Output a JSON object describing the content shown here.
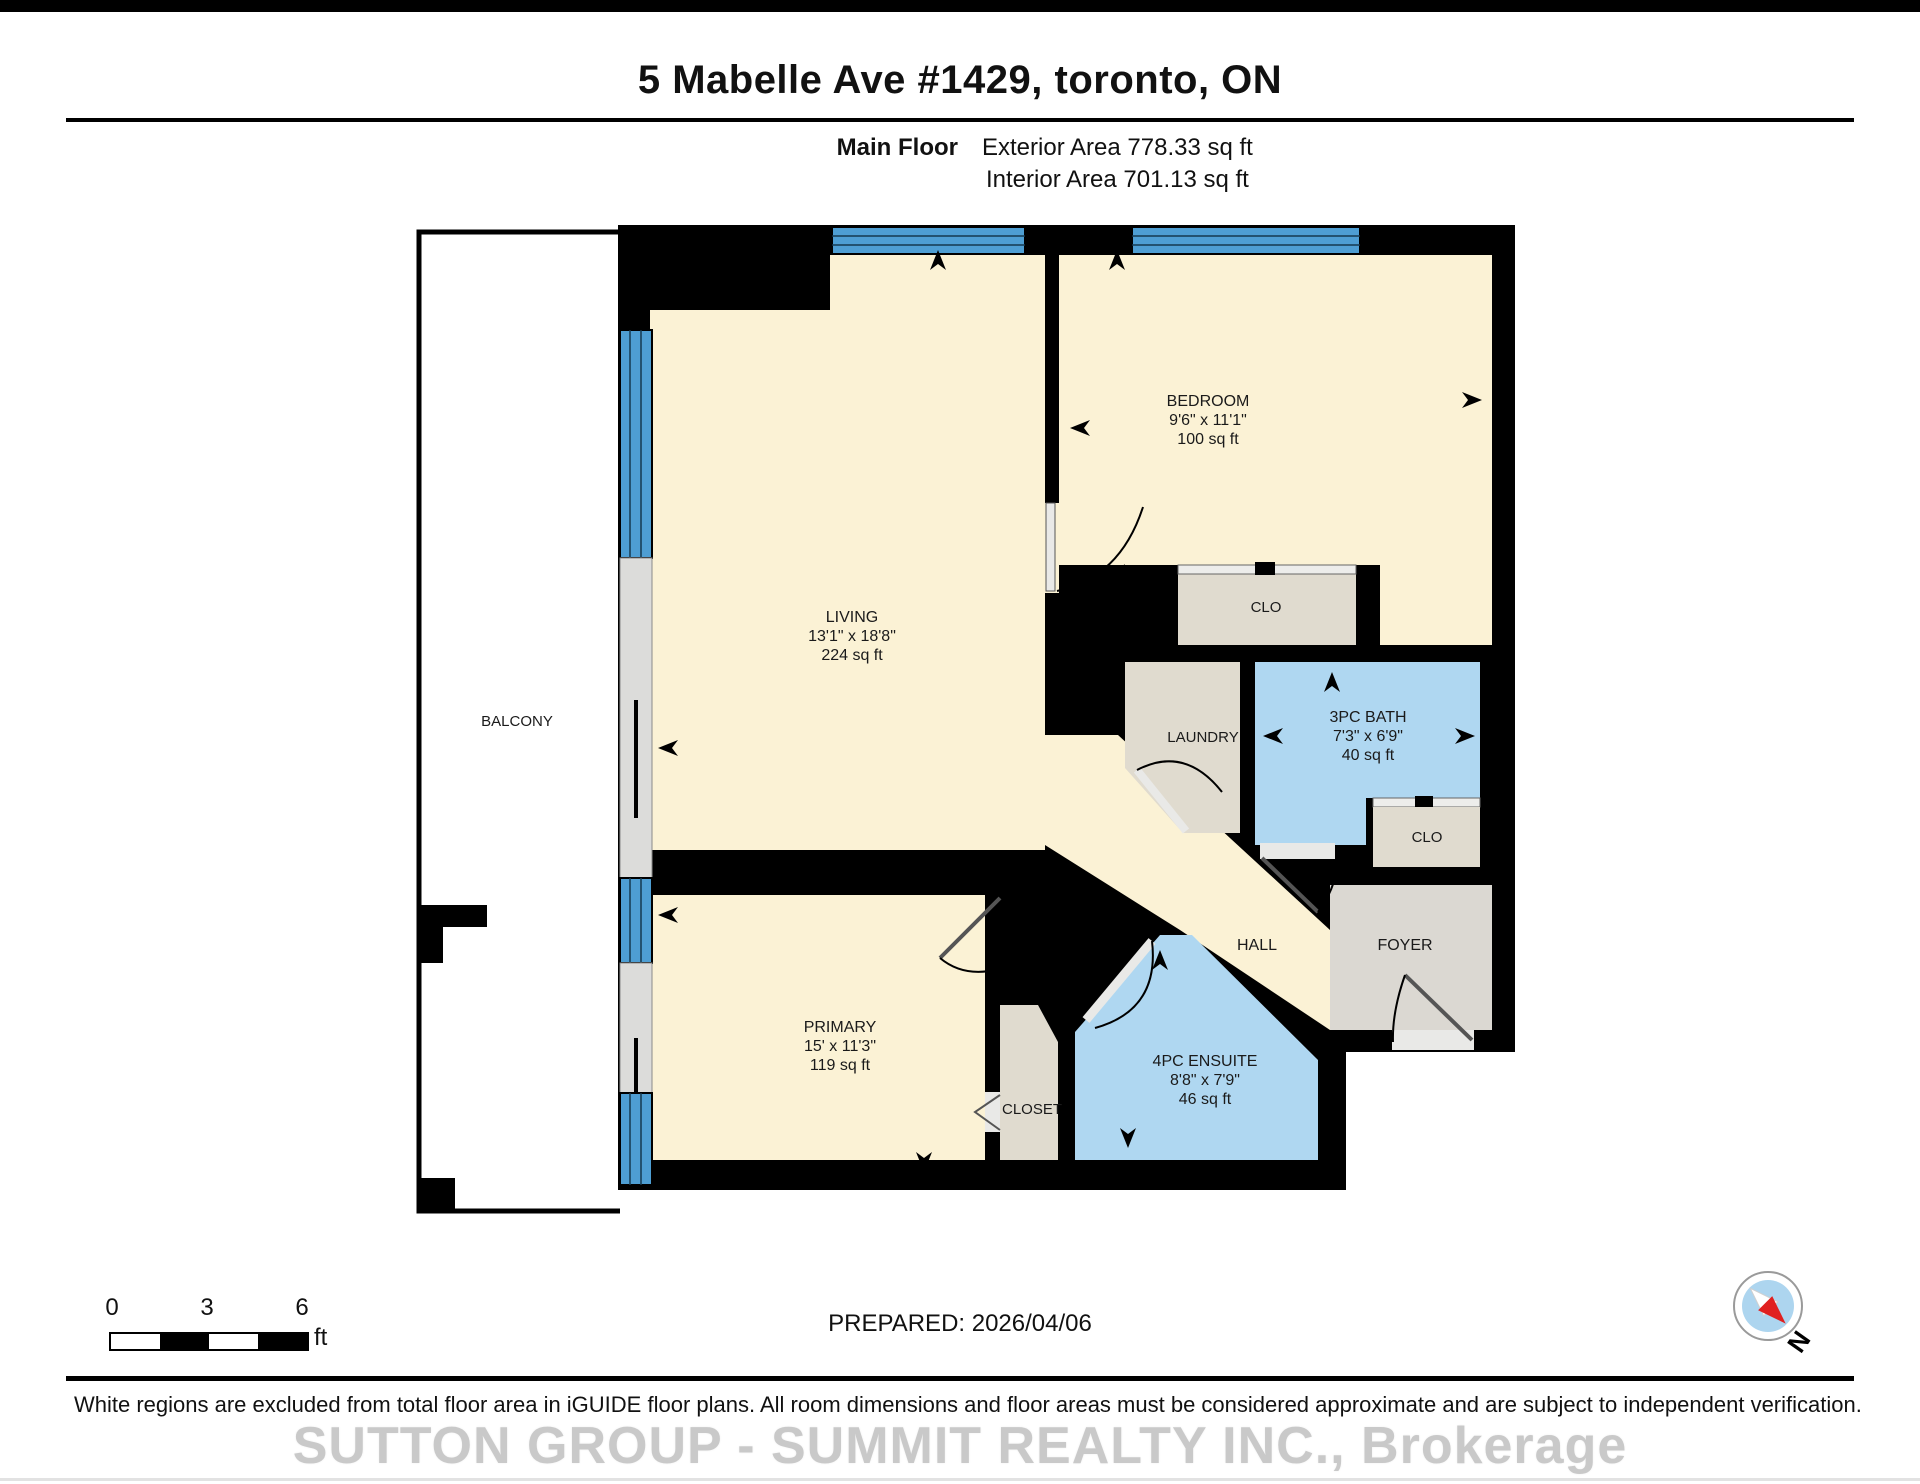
{
  "header": {
    "title": "5 Mabelle Ave #1429, toronto, ON",
    "floor_label": "Main Floor",
    "exterior_area": "Exterior Area 778.33 sq ft",
    "interior_area": "Interior Area 701.13 sq ft"
  },
  "rooms": {
    "living": {
      "name": "LIVING",
      "dims": "13'1\" x 18'8\"",
      "area": "224 sq ft"
    },
    "bedroom": {
      "name": "BEDROOM",
      "dims": "9'6\" x 11'1\"",
      "area": "100 sq ft"
    },
    "bedroom_closet": {
      "name": "CLO"
    },
    "bath": {
      "name": "3PC BATH",
      "dims": "7'3\" x 6'9\"",
      "area": "40 sq ft"
    },
    "laundry": {
      "name": "LAUNDRY"
    },
    "foyer_closet": {
      "name": "CLO"
    },
    "hall": {
      "name": "HALL"
    },
    "foyer": {
      "name": "FOYER"
    },
    "primary": {
      "name": "PRIMARY",
      "dims": "15' x 11'3\"",
      "area": "119 sq ft"
    },
    "closet": {
      "name": "CLOSET"
    },
    "ensuite": {
      "name": "4PC ENSUITE",
      "dims": "8'8\" x 7'9\"",
      "area": "46 sq ft"
    },
    "balcony": {
      "name": "BALCONY"
    }
  },
  "footer": {
    "prepared": "PREPARED: 2026/04/06",
    "disclaimer": "White regions are excluded from total floor area in iGUIDE floor plans. All room dimensions and floor areas must be considered approximate and are subject to independent verification.",
    "watermark": "SUTTON GROUP - SUMMIT REALTY INC., Brokerage",
    "scale": {
      "t0": "0",
      "t3": "3",
      "t6": "6",
      "unit": "ft"
    },
    "compass_n": "N"
  },
  "colors": {
    "wall": "#000000",
    "room_cream": "#FBF2D5",
    "room_tan": "#E0DBCF",
    "room_blue": "#AFD7F1",
    "window_blue": "#4E9ED3",
    "foyer_gray": "#DBD8D2"
  }
}
